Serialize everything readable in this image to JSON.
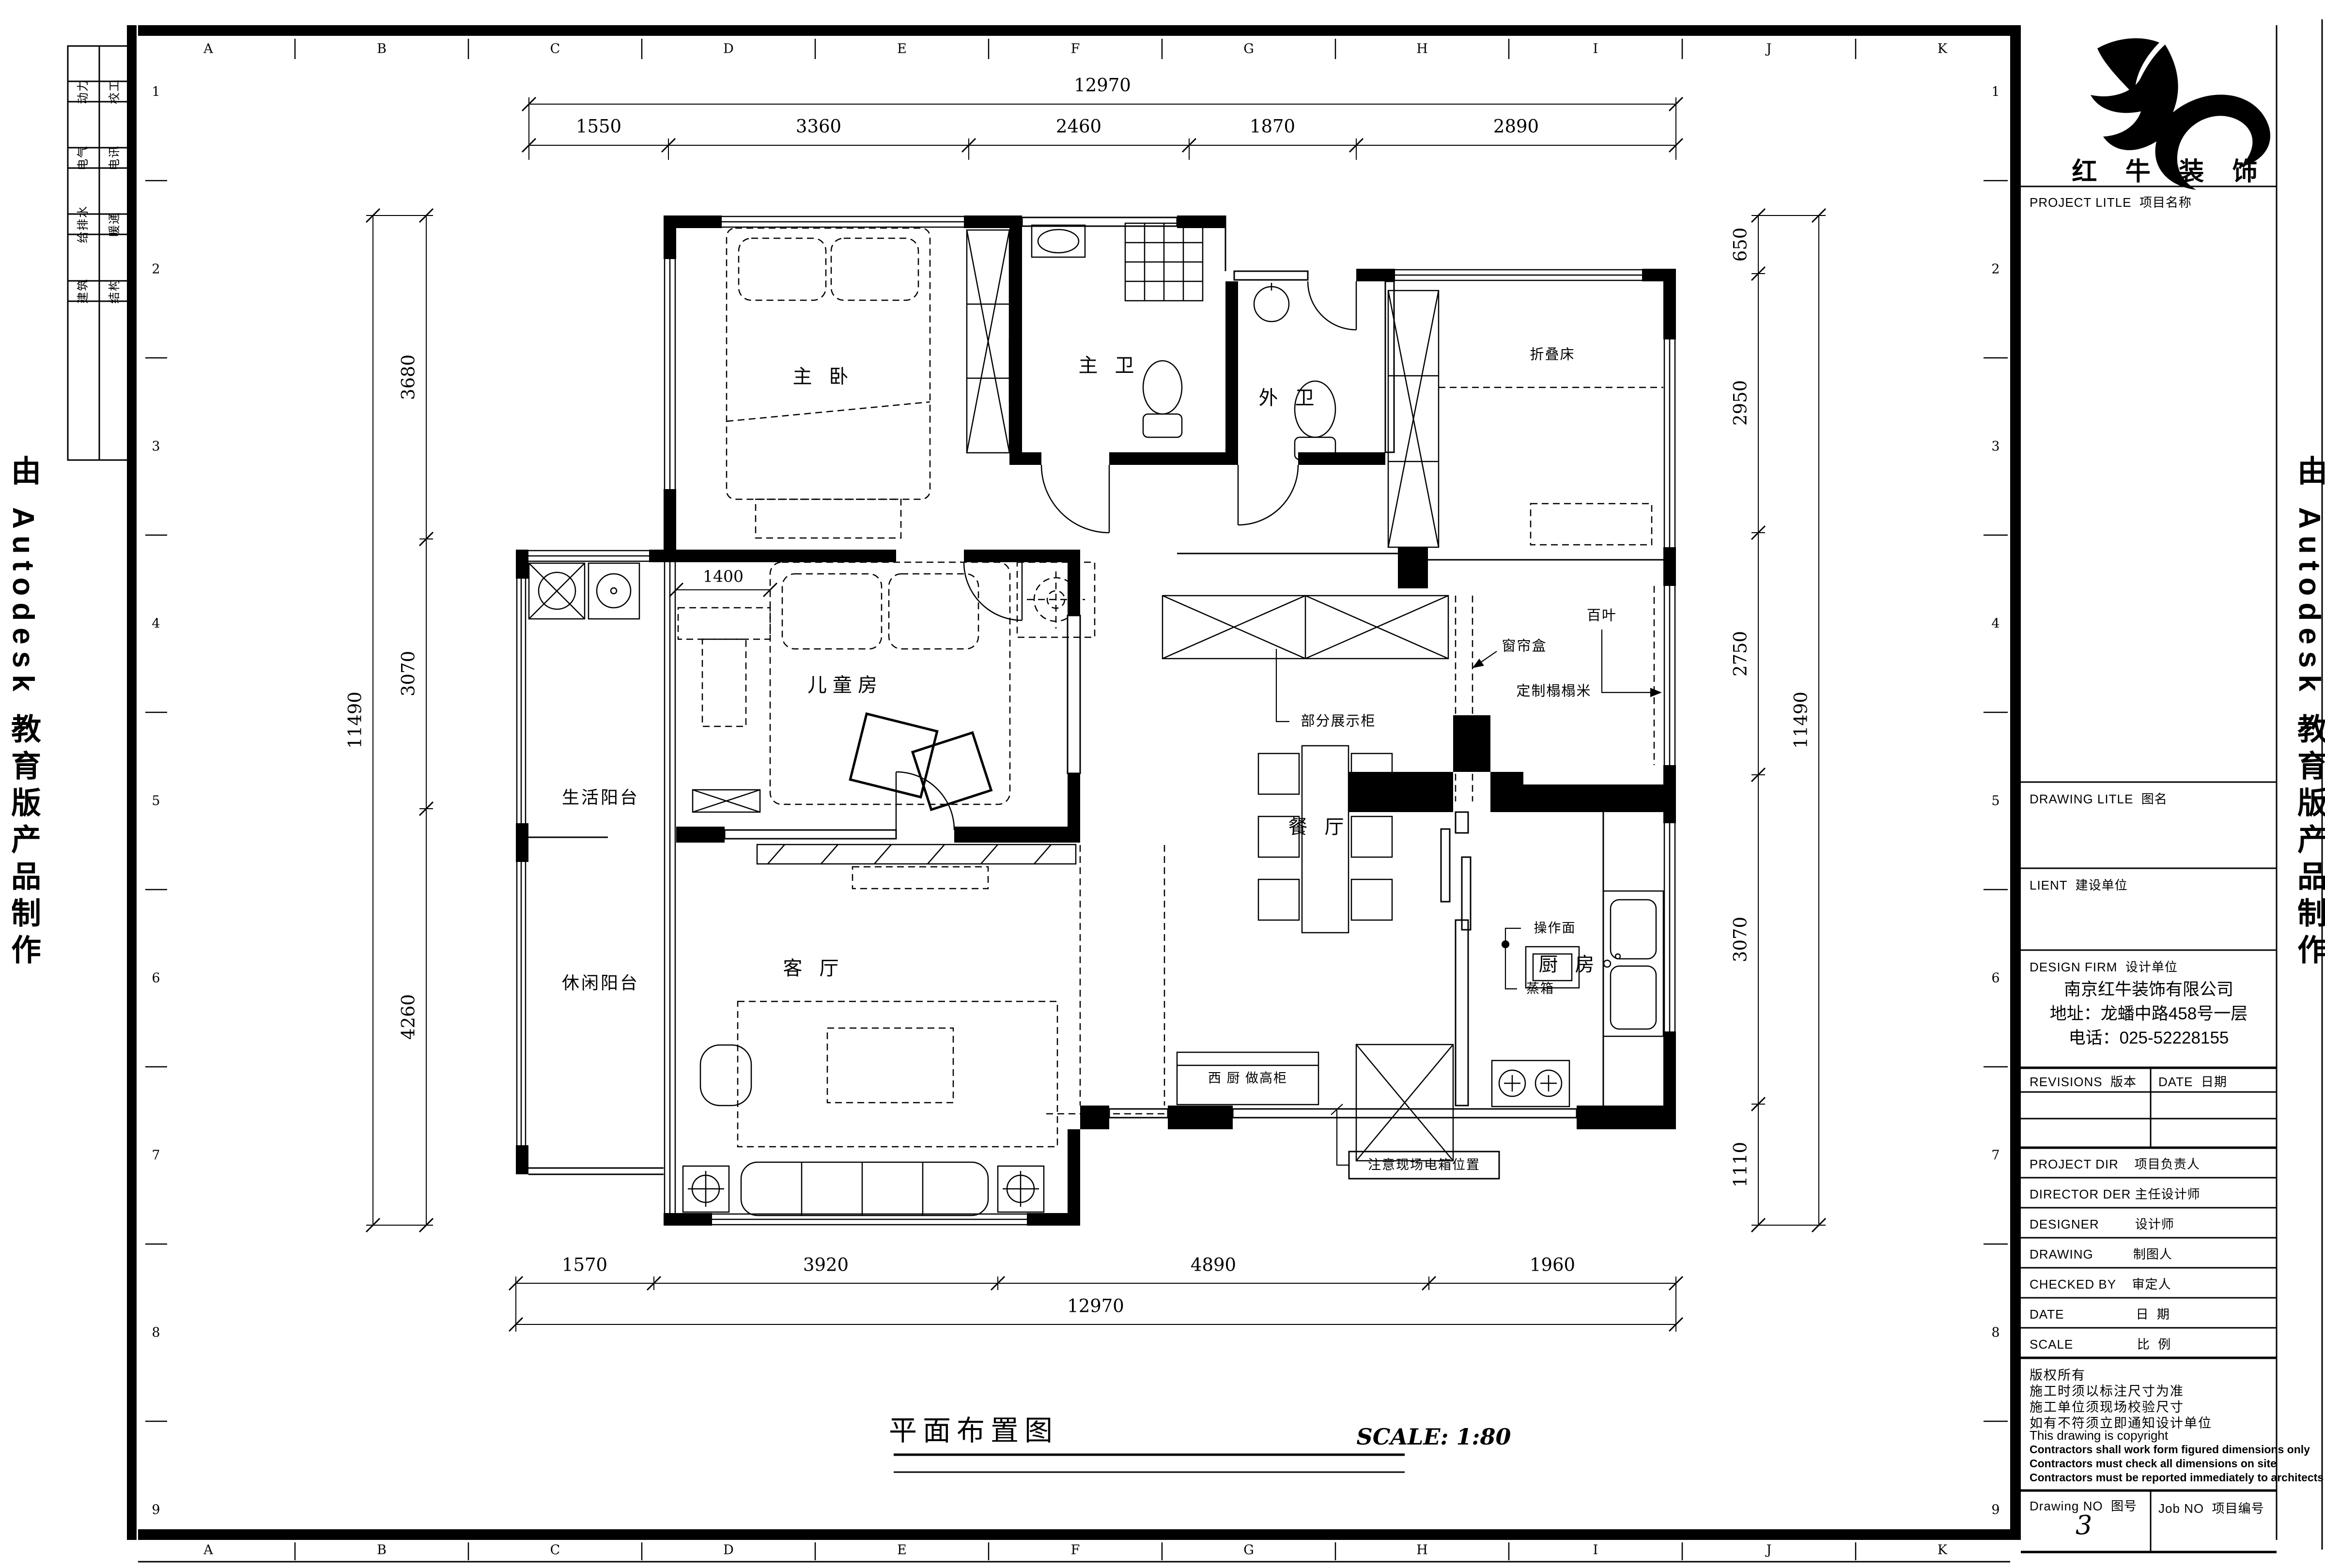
{
  "watermark": {
    "left": "由 Autodesk 教育版产品制作",
    "right": "由 Autodesk 教育版产品制作"
  },
  "grid": {
    "letters": [
      "A",
      "B",
      "C",
      "D",
      "E",
      "F",
      "G",
      "H",
      "I",
      "J",
      "K"
    ],
    "rows": [
      "1",
      "2",
      "3",
      "4",
      "5",
      "6",
      "7",
      "8",
      "9"
    ]
  },
  "disciplines": {
    "col1": [
      "动力",
      "电气",
      "给排水",
      "建筑"
    ],
    "col2": [
      "校工",
      "电讯",
      "暖通",
      "结构"
    ]
  },
  "rooms": {
    "master_bedroom": "主 卧",
    "master_bath": "主 卫",
    "guest_bath": "外 卫",
    "kids_room": "儿童房",
    "utility_balcony": "生活阳台",
    "leisure_balcony": "休闲阳台",
    "living_room": "客 厅",
    "dining_room": "餐 厅",
    "kitchen": "厨 房"
  },
  "annotations": {
    "folding_bed": "折叠床",
    "display_cabinet": "部分展示柜",
    "curtain_box": "窗帘盒",
    "louver": "百叶",
    "custom_tatami": "定制榻榻米",
    "work_surface": "操作面",
    "steam_oven": "蒸箱",
    "west_kitchen_cabinet": "西 厨 做高柜",
    "electric_box_note": "注意现场电箱位置"
  },
  "dimensions": {
    "top_total": "12970",
    "top": [
      "1550",
      "3360",
      "2460",
      "1870",
      "2890"
    ],
    "left_total": "11490",
    "left": [
      "3680",
      "3070",
      "4260"
    ],
    "right_total": "11490",
    "right": [
      "650",
      "2950",
      "2750",
      "3070",
      "1110"
    ],
    "bottom": [
      "1570",
      "3920",
      "4890",
      "1960"
    ],
    "bottom_total": "12970",
    "inner": "1400"
  },
  "footer": {
    "title": "平面布置图",
    "scale": "SCALE: 1:80"
  },
  "title_block": {
    "logo_name": "红 牛 装 饰",
    "project_title_label": "PROJECT LITLE  项目名称",
    "drawing_title_label": "DRAWING LITLE  图名",
    "client_label": "LIENT  建设单位",
    "design_firm_label": "DESIGN FIRM  设计单位",
    "company": [
      "南京红牛装饰有限公司",
      "地址：龙蟠中路458号一层",
      "电话：025-52228155"
    ],
    "revisions_label": "REVISIONS  版本",
    "date_col_label": "DATE  日期",
    "roles": [
      "PROJECT DIR    项目负责人",
      "DIRECTOR DER 主任设计师",
      "DESIGNER         设计师",
      "DRAWING          制图人",
      "CHECKED BY    审定人",
      "DATE                  日  期",
      "SCALE                比  例"
    ],
    "notes": [
      "版权所有",
      "施工时须以标注尺寸为准",
      "施工单位须现场校验尺寸",
      "如有不符须立即通知设计单位",
      "This drawing is copyright",
      "Contractors shall work form figured dimensions only",
      "Contractors must check all dimensions on site",
      "Contractors must be reported immediately to architects"
    ],
    "drawing_no_label": "Drawing NO  图号",
    "drawing_no": "3",
    "job_no_label": "Job NO  项目编号"
  }
}
